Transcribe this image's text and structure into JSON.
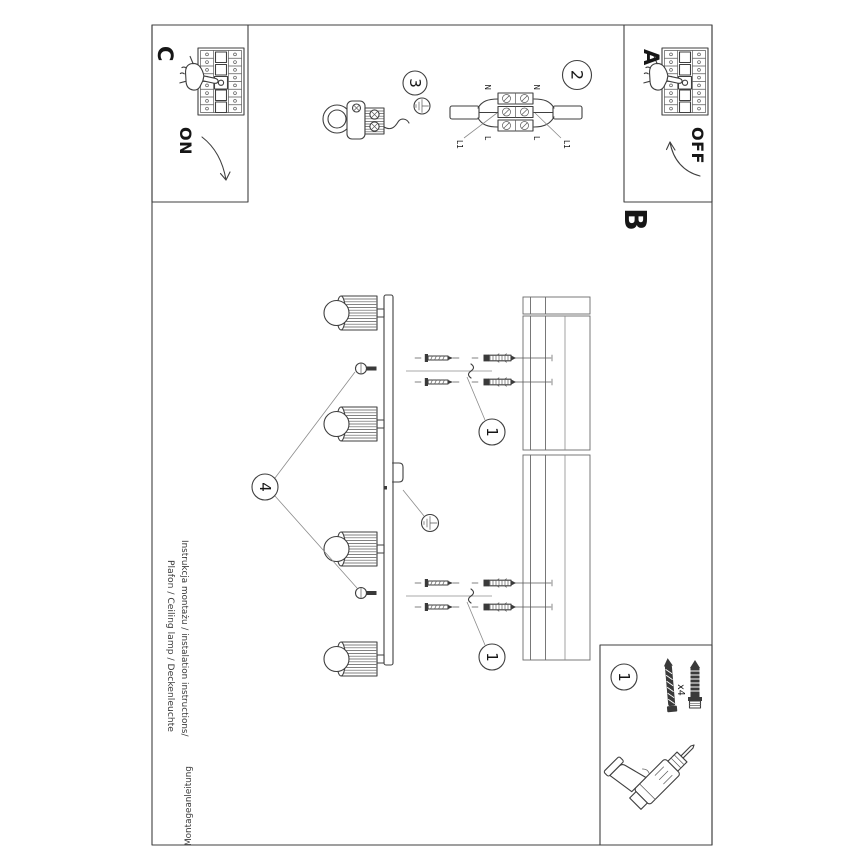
{
  "sheet": {
    "sections": {
      "a": "A",
      "b": "B",
      "c": "C"
    },
    "switch_states": {
      "off": "OFF",
      "on": "ON"
    },
    "steps": {
      "one": "1",
      "two": "2",
      "three": "3",
      "four": "4"
    },
    "wiring_labels": {
      "neutral": "N",
      "live": "L",
      "switched_live": "L1"
    },
    "hardware": {
      "quantity": "x4"
    },
    "footer": {
      "line1": "Instrukcja montażu / instalation instructions/",
      "line1_flipped": "Montageanleitung",
      "line2": "Plafon / Ceiling lamp / Deckenleuchte"
    },
    "colors": {
      "ink": "#3f3f3f",
      "dark_fill": "#3a3a3a",
      "text": "#161616",
      "footer_text": "#3c3c3c",
      "background": "#ffffff"
    }
  }
}
